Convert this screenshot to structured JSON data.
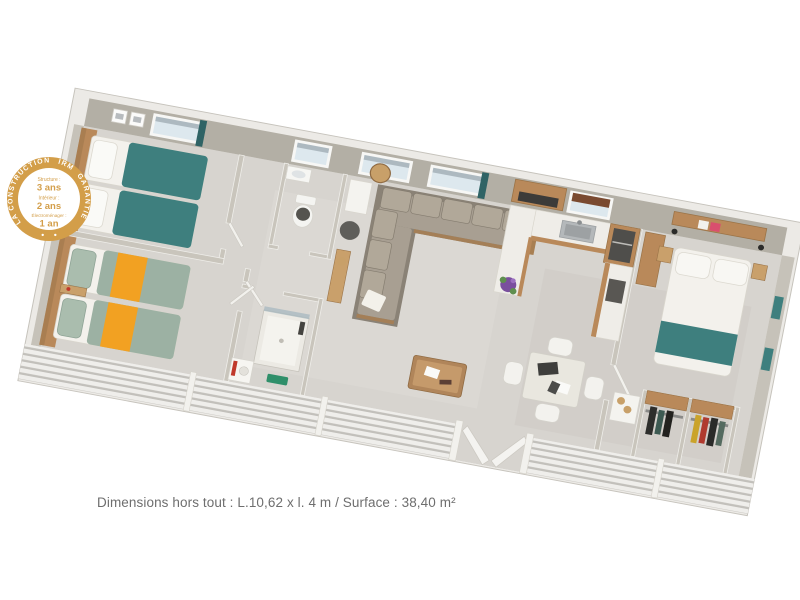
{
  "page": {
    "background": "#ffffff"
  },
  "badge": {
    "ring_parts": [
      "LA CONSTRUCTION",
      "IRM",
      "GARANTIE"
    ],
    "items": [
      {
        "label": "Structure :",
        "value": "3 ans"
      },
      {
        "label": "Intérieur :",
        "value": "2 ans"
      },
      {
        "label": "Électroménager :",
        "value": "1 an"
      }
    ],
    "gold": "#d39e49",
    "text_color": "#ffffff"
  },
  "caption": {
    "text": "Dimensions hors tout : L.10,62 x l. 4 m / Surface : 38,40 m²",
    "color": "#6e6e6e"
  },
  "floorplan": {
    "colors": {
      "floor": "#d7d4cf",
      "floor_light": "#e3e1dc",
      "wall": "#b3afa5",
      "wall_side": "#c6c2b9",
      "wall_top": "#f2f1ed",
      "partition": "#c9c5bc",
      "wood": "#b9895a",
      "wood_light": "#c9a06b",
      "wood_dark": "#9a7347",
      "teal": "#3e7f7e",
      "teal_dark": "#2f6365",
      "sage": "#9cb1a3",
      "orange": "#f2a122",
      "sofa_base": "#8a8276",
      "sofa_cushion": "#a89f92",
      "sofa_back": "#b1a899",
      "mattress": "#f3f1ec",
      "counter": "#efede8",
      "appliance": "#4f4e4b",
      "glass": "#dde8ee",
      "purple": "#7a4f9e",
      "leaf_green": "#5f8f4f",
      "mat_green": "#2f8f6a",
      "towel_red": "#c0392b",
      "book_pink": "#d94f6e"
    }
  }
}
